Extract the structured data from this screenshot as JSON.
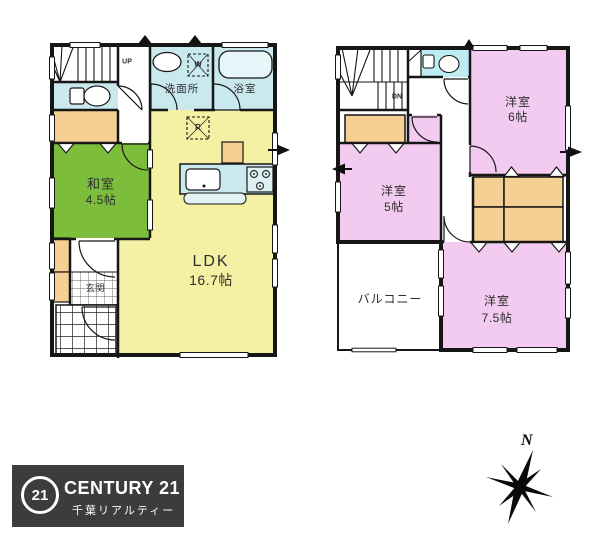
{
  "floor1": {
    "stairs_label": "UP",
    "rooms": {
      "washroom": "洗面所",
      "bathroom": "浴室",
      "japanese_room": {
        "name": "和室",
        "size": "4.5帖"
      },
      "ldk": {
        "name": "LDK",
        "size": "16.7帖"
      },
      "entrance": "玄関"
    },
    "appliance_marks": {
      "washer": "W",
      "fridge": "R"
    }
  },
  "floor2": {
    "stairs_label": "DN",
    "rooms": {
      "bedroom_6": {
        "name": "洋室",
        "size": "6帖"
      },
      "bedroom_5": {
        "name": "洋室",
        "size": "5帖"
      },
      "bedroom_7_5": {
        "name": "洋室",
        "size": "7.5帖"
      },
      "balcony": "バルコニー"
    }
  },
  "logo": {
    "circle_number": "21",
    "brand": "CENTURY 21",
    "company": "千葉リアルティー"
  },
  "compass": {
    "north_label": "N"
  },
  "colors": {
    "tatami_green": "#7cbe3c",
    "ldk_yellow": "#f5f1a4",
    "wet_area_blue": "#c9e9ef",
    "toilet_cyan": "#bdedf2",
    "closet_orange": "#f6cf94",
    "bedroom_pink": "#f3cbf0",
    "wall_black": "#161616",
    "logo_background": "#3d3b3c"
  }
}
